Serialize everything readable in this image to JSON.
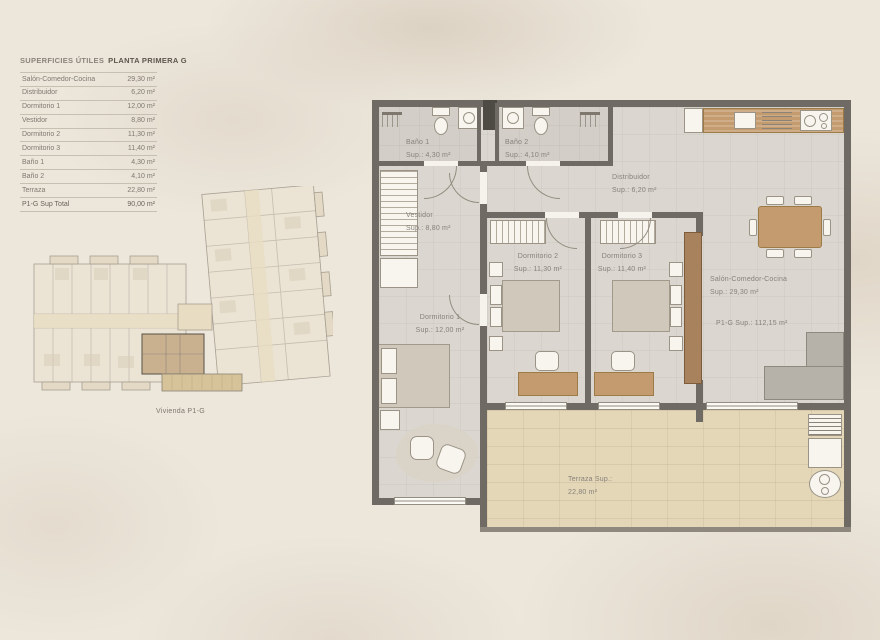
{
  "surfaces_table": {
    "title_left": "SUPERFICIES ÚTILES",
    "title_right": "PLANTA PRIMERA G",
    "rows": [
      {
        "label": "Salón-Comedor-Cocina",
        "value": "29,30 m²"
      },
      {
        "label": "Distribuidor",
        "value": "6,20 m²"
      },
      {
        "label": "Dormitorio 1",
        "value": "12,00 m²"
      },
      {
        "label": "Vestidor",
        "value": "8,80 m²"
      },
      {
        "label": "Dormitorio 2",
        "value": "11,30 m²"
      },
      {
        "label": "Dormitorio 3",
        "value": "11,40 m²"
      },
      {
        "label": "Baño 1",
        "value": "4,30 m²"
      },
      {
        "label": "Baño 2",
        "value": "4,10 m²"
      },
      {
        "label": "Terraza",
        "value": "22,80 m²"
      }
    ],
    "total": {
      "label": "P1-G Sup Total",
      "value": "90,00 m²"
    }
  },
  "keyplan": {
    "caption": "Vivienda P1-G"
  },
  "plan": {
    "rooms": {
      "bano1": {
        "name": "Baño 1",
        "sup": "Sup.: 4,30 m²"
      },
      "bano2": {
        "name": "Baño 2",
        "sup": "Sup.: 4,10 m²"
      },
      "distribuidor": {
        "name": "Distribuidor",
        "sup": "Sup.: 6,20 m²"
      },
      "vestidor": {
        "name": "Vestidor",
        "sup": "Sup.: 8,80 m²"
      },
      "dormitorio1": {
        "name": "Dormitorio 1",
        "sup": "Sup.: 12,00 m²"
      },
      "dormitorio2": {
        "name": "Dormitorio 2",
        "sup": "Sup.: 11,30 m²"
      },
      "dormitorio3": {
        "name": "Dormitorio 3",
        "sup": "Sup.: 11,40 m²"
      },
      "salon": {
        "name": "Salón-Comedor-Cocina",
        "sup": "Sup.: 29,30 m²"
      },
      "terraza": {
        "name": "Terraza Sup.:",
        "sup": "22,80 m²"
      }
    },
    "total_label": "P1-G Sup.: 112,15 m²"
  },
  "colors": {
    "wall": "#6f6a63",
    "wood": "#c49b6e",
    "floor": "#dbd7d0",
    "floor_bath": "#d3cfc8",
    "terrace_floor": "#e4d7b8",
    "bed": "#d0c8ba",
    "sofa": "#b6b1a9",
    "text_muted": "#87817a",
    "title_accent": "#5b554c",
    "keyplan_highlight": "#c9b190"
  }
}
